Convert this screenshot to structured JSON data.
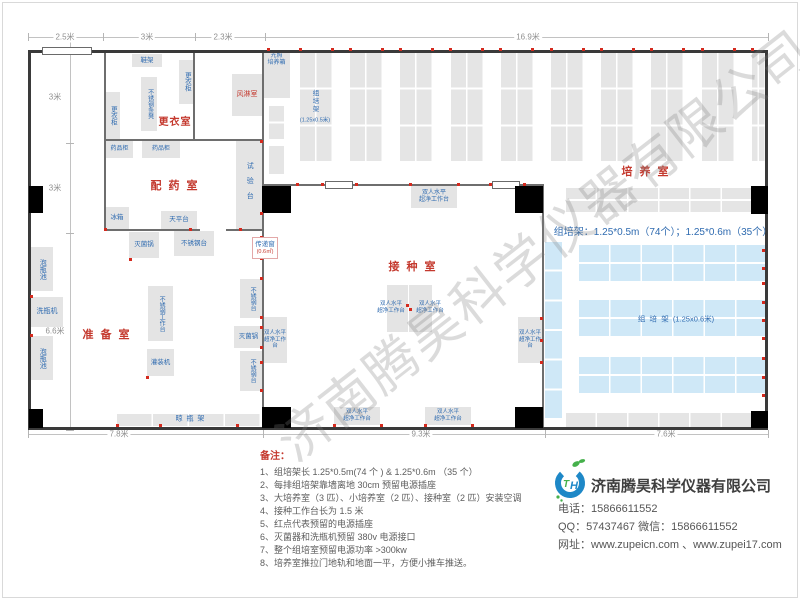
{
  "watermark": {
    "text": "济南腾昊科学仪器有限公司"
  },
  "plan": {
    "walls": [
      {
        "x": 28,
        "y": 50,
        "w": 740,
        "h": 3
      },
      {
        "x": 28,
        "y": 427,
        "w": 740,
        "h": 3
      },
      {
        "x": 28,
        "y": 50,
        "w": 3,
        "h": 380
      },
      {
        "x": 765,
        "y": 50,
        "w": 3,
        "h": 380
      },
      {
        "x": 104,
        "y": 52,
        "w": 2,
        "h": 178,
        "t": "i"
      },
      {
        "x": 193,
        "y": 52,
        "w": 2,
        "h": 88,
        "t": "i"
      },
      {
        "x": 104,
        "y": 139,
        "w": 160,
        "h": 2,
        "t": "i"
      },
      {
        "x": 104,
        "y": 229,
        "w": 96,
        "h": 2,
        "t": "i"
      },
      {
        "x": 226,
        "y": 229,
        "w": 38,
        "h": 2,
        "t": "i"
      },
      {
        "x": 262,
        "y": 52,
        "w": 2,
        "h": 376,
        "t": "i"
      },
      {
        "x": 262,
        "y": 184,
        "w": 282,
        "h": 2,
        "t": "i"
      },
      {
        "x": 542,
        "y": 184,
        "w": 2,
        "h": 244,
        "t": "i"
      }
    ],
    "doors": [
      {
        "x": 42,
        "y": 47,
        "w": 50,
        "h": 8
      },
      {
        "x": 325,
        "y": 181,
        "w": 28,
        "h": 8
      },
      {
        "x": 492,
        "y": 181,
        "w": 28,
        "h": 8
      }
    ],
    "columns": [
      {
        "x": 29,
        "y": 186,
        "w": 14,
        "h": 27
      },
      {
        "x": 262,
        "y": 186,
        "w": 29,
        "h": 27
      },
      {
        "x": 515,
        "y": 186,
        "w": 28,
        "h": 27
      },
      {
        "x": 751,
        "y": 186,
        "w": 17,
        "h": 28
      },
      {
        "x": 262,
        "y": 407,
        "w": 29,
        "h": 21
      },
      {
        "x": 515,
        "y": 407,
        "w": 28,
        "h": 21
      },
      {
        "x": 751,
        "y": 411,
        "w": 17,
        "h": 17
      },
      {
        "x": 29,
        "y": 409,
        "w": 14,
        "h": 19
      }
    ],
    "rack_strips": {
      "x0": 300,
      "step": 50.2,
      "count": 10,
      "y": 53,
      "w": 33,
      "h": 110,
      "rows": 3,
      "cols": 2,
      "clip": 766
    },
    "racks": [
      {
        "x": 269,
        "y": 106,
        "w": 15,
        "h": 35,
        "cols": 1,
        "rows": 2,
        "c": "g"
      },
      {
        "x": 269,
        "y": 146,
        "w": 15,
        "h": 28,
        "cols": 1,
        "rows": 1,
        "c": "g"
      },
      {
        "x": 566,
        "y": 188,
        "w": 187,
        "h": 26,
        "cols": 6,
        "rows": 2,
        "c": "g"
      },
      {
        "x": 545,
        "y": 242,
        "w": 17,
        "h": 178,
        "cols": 1,
        "rows": 6,
        "c": "b"
      },
      {
        "x": 579,
        "y": 245,
        "w": 189,
        "h": 38,
        "cols": 6,
        "rows": 2,
        "c": "b"
      },
      {
        "x": 579,
        "y": 300,
        "w": 189,
        "h": 38,
        "cols": 6,
        "rows": 2,
        "c": "b"
      },
      {
        "x": 579,
        "y": 357,
        "w": 189,
        "h": 38,
        "cols": 6,
        "rows": 2,
        "c": "b"
      },
      {
        "x": 566,
        "y": 413,
        "w": 187,
        "h": 14,
        "cols": 6,
        "rows": 1,
        "c": "g"
      },
      {
        "x": 117,
        "y": 414,
        "w": 144,
        "h": 12,
        "cols": 4,
        "rows": 1,
        "c": "g"
      }
    ],
    "equipment": [
      {
        "label": "鞋架",
        "x": 132,
        "y": 54,
        "w": 30,
        "h": 13,
        "o": "h",
        "fs": 6.5
      },
      {
        "label": "更衣柜",
        "x": 179,
        "y": 60,
        "w": 15,
        "h": 44,
        "o": "v",
        "fs": 6.5
      },
      {
        "label": "不锈钢条凳",
        "x": 141,
        "y": 77,
        "w": 16,
        "h": 54,
        "o": "v",
        "fs": 6
      },
      {
        "label": "更衣柜",
        "x": 105,
        "y": 92,
        "w": 15,
        "h": 47,
        "o": "v",
        "fs": 6.5
      },
      {
        "label": "风淋室",
        "x": 232,
        "y": 74,
        "w": 30,
        "h": 42,
        "o": "h",
        "c": "red",
        "fs": 7
      },
      {
        "label": "光照\n培养箱",
        "x": 263,
        "y": 53,
        "w": 27,
        "h": 45,
        "o": "h",
        "fs": 6,
        "top": true
      },
      {
        "label": "药品柜",
        "x": 106,
        "y": 141,
        "w": 27,
        "h": 17,
        "o": "h",
        "fs": 6
      },
      {
        "label": "药品柜",
        "x": 142,
        "y": 141,
        "w": 38,
        "h": 17,
        "o": "h",
        "fs": 6
      },
      {
        "label": "试验台",
        "x": 236,
        "y": 139,
        "w": 26,
        "h": 91,
        "o": "v",
        "fs": 7,
        "ls": 8
      },
      {
        "label": "冰箱",
        "x": 105,
        "y": 207,
        "w": 24,
        "h": 22,
        "o": "h",
        "fs": 6.5
      },
      {
        "label": "天平台",
        "x": 161,
        "y": 211,
        "w": 36,
        "h": 18,
        "o": "h",
        "fs": 6.5
      },
      {
        "label": "灭菌锅",
        "x": 129,
        "y": 232,
        "w": 30,
        "h": 26,
        "o": "h",
        "fs": 6.5
      },
      {
        "label": "不锈钢台",
        "x": 174,
        "y": 231,
        "w": 40,
        "h": 25,
        "o": "h",
        "fs": 6.5
      },
      {
        "label": "泡瓶池",
        "x": 31,
        "y": 247,
        "w": 22,
        "h": 44,
        "o": "v",
        "fs": 7
      },
      {
        "label": "洗瓶机",
        "x": 31,
        "y": 297,
        "w": 32,
        "h": 30,
        "o": "h",
        "fs": 7
      },
      {
        "label": "泡瓶池",
        "x": 31,
        "y": 336,
        "w": 22,
        "h": 44,
        "o": "v",
        "fs": 7
      },
      {
        "label": "不锈钢工作台",
        "x": 148,
        "y": 286,
        "w": 25,
        "h": 55,
        "o": "v",
        "fs": 6
      },
      {
        "label": "灌装机",
        "x": 147,
        "y": 349,
        "w": 27,
        "h": 27,
        "o": "h",
        "fs": 6.5
      },
      {
        "label": "不锈钢台",
        "x": 240,
        "y": 279,
        "w": 23,
        "h": 39,
        "o": "v",
        "fs": 6
      },
      {
        "label": "灭菌锅",
        "x": 234,
        "y": 326,
        "w": 29,
        "h": 22,
        "o": "h",
        "fs": 6.5
      },
      {
        "label": "不锈钢台",
        "x": 240,
        "y": 351,
        "w": 23,
        "h": 40,
        "o": "v",
        "fs": 6
      },
      {
        "label": "双人水平\n超净工作台",
        "x": 411,
        "y": 186,
        "w": 46,
        "h": 22,
        "o": "h",
        "fs": 6
      },
      {
        "label": "双人水平\n超净工作台",
        "x": 263,
        "y": 317,
        "w": 24,
        "h": 46,
        "o": "h",
        "fs": 5.5
      },
      {
        "label": "双人水平\n超净工作台",
        "x": 518,
        "y": 317,
        "w": 24,
        "h": 46,
        "o": "h",
        "fs": 5.5
      },
      {
        "label": "",
        "x": 387,
        "y": 285,
        "w": 21,
        "h": 47,
        "o": "h"
      },
      {
        "label": "",
        "x": 409,
        "y": 285,
        "w": 23,
        "h": 47,
        "o": "h"
      },
      {
        "label": "双人水平\n超净工作台",
        "x": 334,
        "y": 407,
        "w": 46,
        "h": 18,
        "o": "h",
        "fs": 5.5
      },
      {
        "label": "双人水平\n超净工作台",
        "x": 425,
        "y": 407,
        "w": 46,
        "h": 18,
        "o": "h",
        "fs": 5.5
      }
    ],
    "labels": [
      {
        "t": "更衣室",
        "cx": 175,
        "cy": 123,
        "fs": 10,
        "cls": "room",
        "ls": 1
      },
      {
        "t": "配 药 室",
        "cx": 175,
        "cy": 187,
        "fs": 11,
        "cls": "room",
        "ls": 2
      },
      {
        "t": "准 备 室",
        "cx": 107,
        "cy": 336,
        "fs": 11,
        "cls": "room",
        "ls": 2
      },
      {
        "t": "接 种 室",
        "cx": 413,
        "cy": 268,
        "fs": 11,
        "cls": "room",
        "ls": 2
      },
      {
        "t": "培 养 室",
        "cx": 646,
        "cy": 173,
        "fs": 11,
        "cls": "room",
        "ls": 2
      },
      {
        "t": "组培架：1.25*0.5m（74个）；1.25*0.6m（35个）",
        "cx": 663,
        "cy": 233,
        "fs": 10
      },
      {
        "t": "组  培  架  (1.25x0.6米)",
        "cx": 676,
        "cy": 319,
        "fs": 7.5
      },
      {
        "t": "组\n培\n架",
        "cx": 316,
        "cy": 102,
        "fs": 6.5
      },
      {
        "t": "(1.25x0.5米)",
        "cx": 315,
        "cy": 121,
        "fs": 5.5
      },
      {
        "t": "晾  瓶  架",
        "cx": 190,
        "cy": 420,
        "fs": 7
      },
      {
        "t": "双人水平\n超净工作台",
        "cx": 391,
        "cy": 308,
        "fs": 5.5
      },
      {
        "t": "双人水平\n超净工作台",
        "cx": 430,
        "cy": 308,
        "fs": 5.5
      }
    ],
    "passbox": {
      "x": 252,
      "y": 237,
      "w": 26,
      "h": 22,
      "label": "传递窗",
      "sub": "(0.6㎡)"
    },
    "sockets": [
      [
        268,
        49
      ],
      [
        300,
        49
      ],
      [
        332,
        49
      ],
      [
        350,
        49
      ],
      [
        382,
        49
      ],
      [
        400,
        49
      ],
      [
        432,
        49
      ],
      [
        450,
        49
      ],
      [
        482,
        49
      ],
      [
        500,
        49
      ],
      [
        532,
        49
      ],
      [
        551,
        49
      ],
      [
        583,
        49
      ],
      [
        601,
        49
      ],
      [
        633,
        49
      ],
      [
        651,
        49
      ],
      [
        683,
        49
      ],
      [
        702,
        49
      ],
      [
        734,
        49
      ],
      [
        752,
        49
      ],
      [
        297,
        184
      ],
      [
        322,
        184
      ],
      [
        356,
        184
      ],
      [
        410,
        184
      ],
      [
        458,
        184
      ],
      [
        490,
        184
      ],
      [
        524,
        184
      ],
      [
        261,
        213
      ],
      [
        261,
        237
      ],
      [
        261,
        258
      ],
      [
        261,
        278
      ],
      [
        261,
        317
      ],
      [
        261,
        327
      ],
      [
        261,
        347
      ],
      [
        261,
        362
      ],
      [
        261,
        390
      ],
      [
        541,
        318
      ],
      [
        541,
        340
      ],
      [
        541,
        362
      ],
      [
        117,
        425
      ],
      [
        160,
        425
      ],
      [
        237,
        425
      ],
      [
        334,
        425
      ],
      [
        381,
        425
      ],
      [
        425,
        425
      ],
      [
        472,
        425
      ],
      [
        763,
        250
      ],
      [
        763,
        268
      ],
      [
        763,
        283
      ],
      [
        763,
        302
      ],
      [
        763,
        320
      ],
      [
        763,
        338
      ],
      [
        763,
        358
      ],
      [
        763,
        377
      ],
      [
        763,
        395
      ],
      [
        31,
        296
      ],
      [
        31,
        335
      ],
      [
        105,
        229
      ],
      [
        190,
        229
      ],
      [
        240,
        229
      ],
      [
        261,
        141
      ],
      [
        147,
        377
      ],
      [
        130,
        259
      ],
      [
        407,
        305
      ],
      [
        410,
        309
      ]
    ],
    "dims": {
      "top": {
        "line": {
          "x1": 28,
          "x2": 768,
          "y": 37
        },
        "ticks": [
          28,
          103,
          195,
          265,
          768
        ],
        "labels": [
          {
            "text": "2.5米",
            "cx": 65
          },
          {
            "text": "3米",
            "cx": 147
          },
          {
            "text": "2.3米",
            "cx": 223
          },
          {
            "text": "16.9米",
            "cx": 528
          }
        ]
      },
      "left": {
        "line": {
          "y1": 42,
          "y2": 430,
          "x": 70
        },
        "ticks": [
          51,
          143,
          233,
          430
        ],
        "labels": [
          {
            "text": "3米",
            "cy": 97
          },
          {
            "text": "3米",
            "cy": 188
          },
          {
            "text": "6.6米",
            "cy": 331
          }
        ]
      },
      "bottom": {
        "line": {
          "x1": 28,
          "x2": 768,
          "y": 434
        },
        "ticks": [
          28,
          263,
          545,
          768
        ],
        "labels": [
          {
            "text": "7.8米",
            "cx": 119
          },
          {
            "text": "9.3米",
            "cx": 421
          },
          {
            "text": "7.6米",
            "cx": 666
          }
        ]
      }
    }
  },
  "notes": {
    "title": "备注：",
    "items": [
      "1、组培架长 1.25*0.5m(74 个 ) & 1.25*0.6m （35 个）",
      "2、每排组培架靠墙离地 30cm 预留电源插座",
      "3、大培养室（3 匹）、小培养室（2 匹）、接种室（2 匹）安装空调",
      "4、接种工作台长为 1.5 米",
      "5、红点代表预留的电源插座",
      "6、灭菌器和洗瓶机预留 380v 电源接口",
      "7、整个组培室预留电源功率 >300kw",
      "8、培养室推拉门地轨和地面一平，方便小推车推送。"
    ]
  },
  "company": {
    "logo_t": "T",
    "logo_h": "H",
    "name": "济南腾昊科学仪器有限公司",
    "phone": "电话：15866611552",
    "qq_wechat": "QQ：57437467   微信：15866611552",
    "web": "网址：www.zupeicn.com 、www.zupei17.com"
  }
}
